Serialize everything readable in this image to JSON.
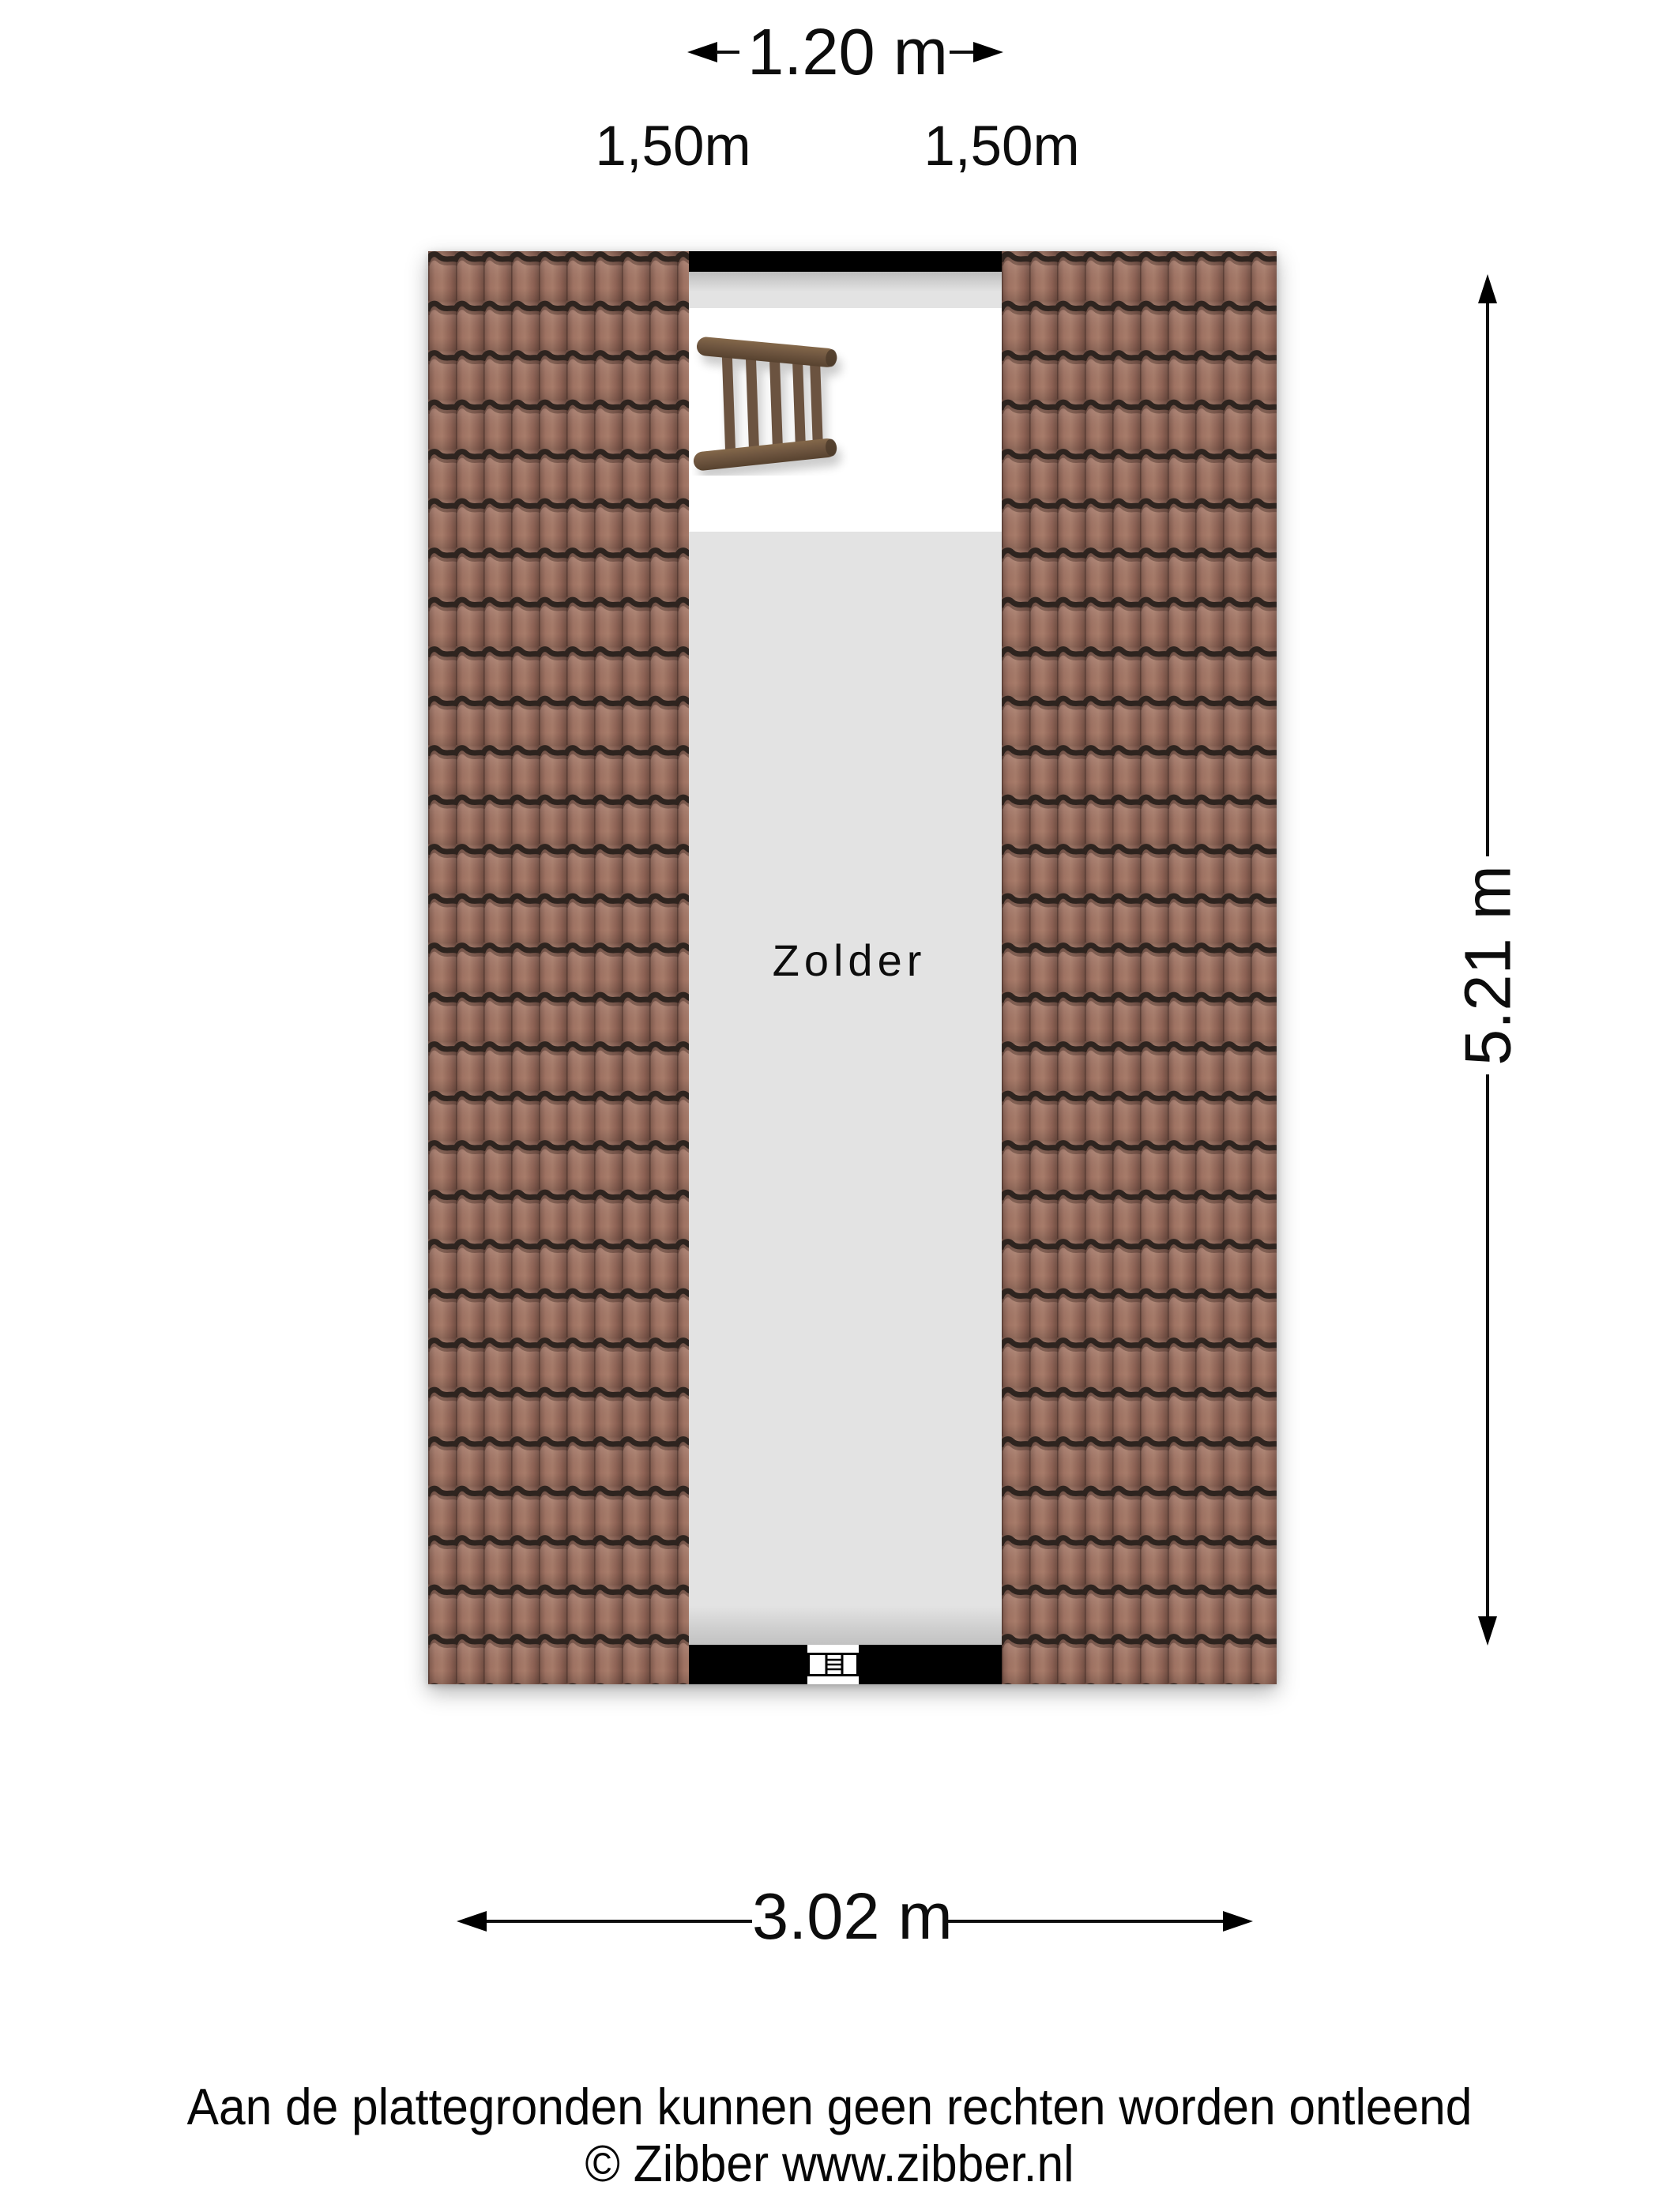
{
  "plan": {
    "room_label": "Zolder"
  },
  "dimensions": {
    "width_top": "1.20 m",
    "height_left": "1,50m",
    "height_right": "1,50m",
    "length_right": "5.21 m",
    "width_bottom": "3.02 m"
  },
  "footer": {
    "disclaimer": "Aan de plattegronden kunnen geen rechten worden ontleend",
    "copyright": "© Zibber www.zibber.nl"
  },
  "icons": {
    "ladder": "loft-ladder-icon",
    "hatch": "attic-hatch-icon"
  },
  "colors": {
    "background": "#ffffff",
    "wall": "#000000",
    "floor_gray": "#e3e3e3",
    "roof_tile_base": "#9c7060",
    "roof_tile_highlight": "#a87c6a",
    "roof_tile_dark_line": "#2e241f",
    "ladder_wood": "#6f5640",
    "text": "#0d0d0d"
  }
}
